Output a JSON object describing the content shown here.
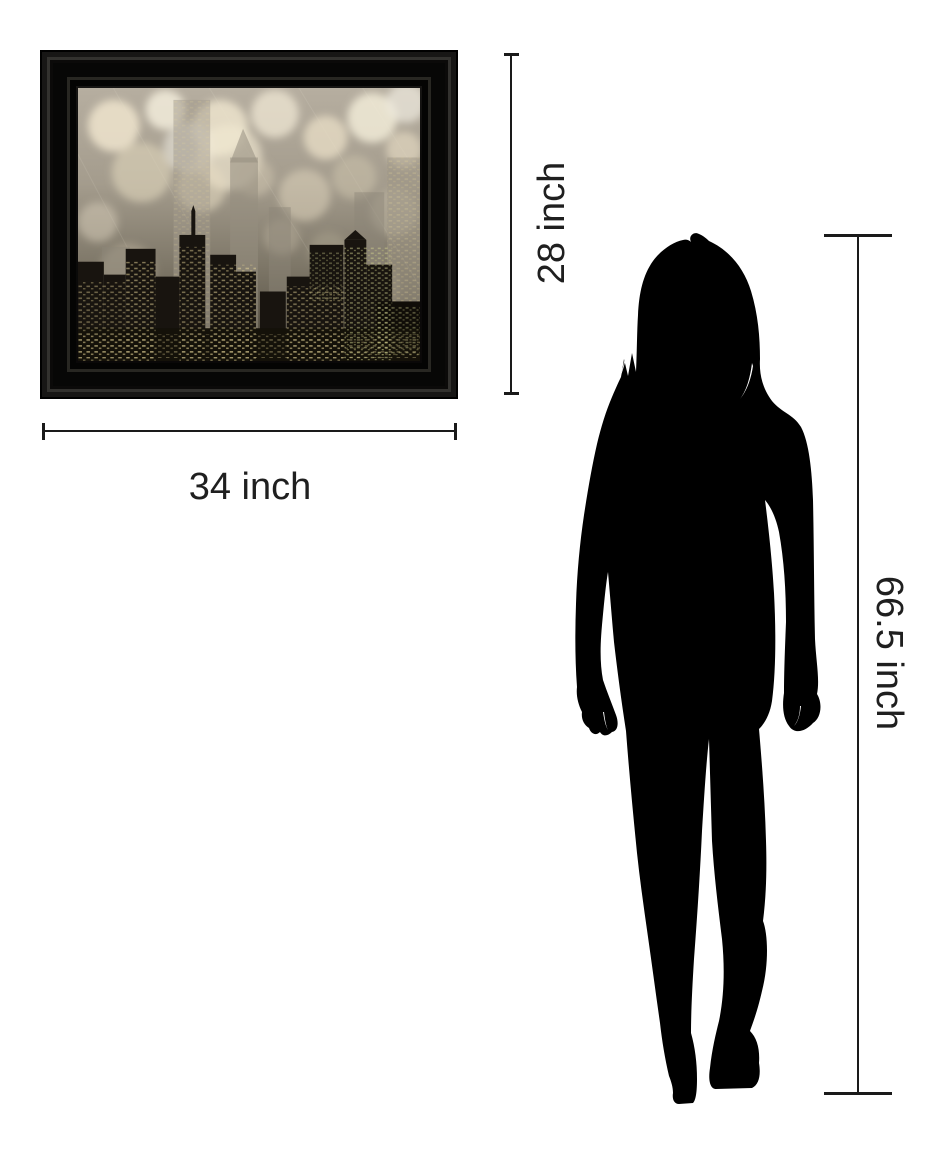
{
  "page": {
    "background_color": "#ffffff",
    "type": "wall-art-size-guide"
  },
  "size_guide": {
    "labels": {
      "width": "34 inch",
      "height": "28 inch",
      "person_height": "66.5 inch"
    },
    "artwork": {
      "subject": "city-skyline-silhouette-with-bokeh-lights",
      "frame_color": "#0c0b0a",
      "palette": [
        "#b6aea0",
        "#f0e7d0",
        "#8b8577",
        "#18140f",
        "#e9d89b"
      ]
    },
    "person": {
      "subject": "standing-woman-silhouette",
      "color": "#000000"
    },
    "line_color": "#1a1a1a",
    "label_color": "#1f1f1f"
  }
}
